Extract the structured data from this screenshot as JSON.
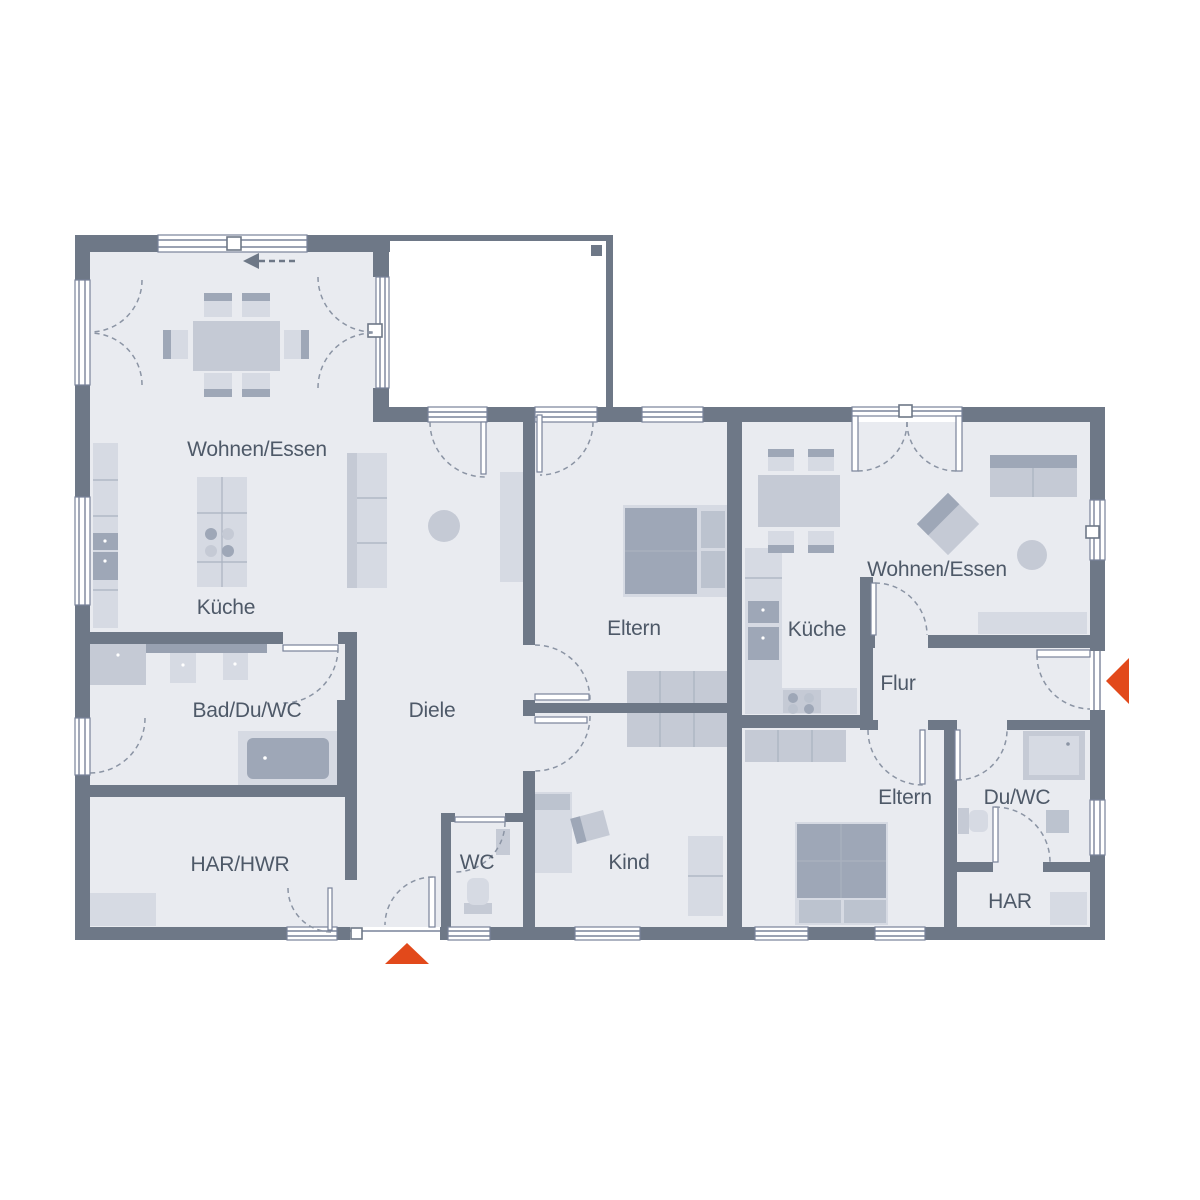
{
  "plan": {
    "type": "floor-plan",
    "rooms": [
      {
        "id": "wohnen-essen-left",
        "label": "Wohnen/Essen"
      },
      {
        "id": "kueche-left",
        "label": "Küche"
      },
      {
        "id": "bad-du-wc",
        "label": "Bad/Du/WC"
      },
      {
        "id": "diele",
        "label": "Diele"
      },
      {
        "id": "har-hwr",
        "label": "HAR/HWR"
      },
      {
        "id": "wc",
        "label": "WC"
      },
      {
        "id": "eltern-middle",
        "label": "Eltern"
      },
      {
        "id": "kind",
        "label": "Kind"
      },
      {
        "id": "wohnen-essen-right",
        "label": "Wohnen/Essen"
      },
      {
        "id": "kueche-right",
        "label": "Küche"
      },
      {
        "id": "flur",
        "label": "Flur"
      },
      {
        "id": "eltern-right",
        "label": "Eltern"
      },
      {
        "id": "du-wc-right",
        "label": "Du/WC"
      },
      {
        "id": "har-right",
        "label": "HAR"
      }
    ],
    "markers": {
      "entrance_bottom": "entrance-arrow-up",
      "entrance_right": "entrance-arrow-left",
      "sliding_direction": "slide-arrow-left",
      "terrace_column": "column-marker"
    },
    "colors": {
      "wall": "#6e7887",
      "floor": "#e9ebf0",
      "furniture_light": "#d6dae3",
      "furniture_mid": "#c5cad5",
      "furniture_dark": "#9ea7b7",
      "accent": "#e2491b",
      "text": "#4e5968"
    }
  }
}
